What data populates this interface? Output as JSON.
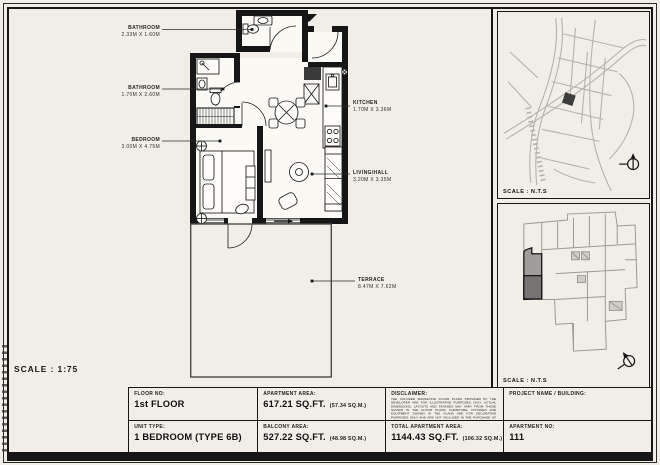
{
  "sheet": {
    "scale_label": "SCALE : 1:75",
    "bg_color": "#f0eee6",
    "line_color": "#161616",
    "accent_gray": "#767472"
  },
  "floor_plan": {
    "labels": [
      {
        "name": "BATHROOM",
        "dims": "2.33M X 1.60M"
      },
      {
        "name": "BATHROOM",
        "dims": "1.70M X 2.60M"
      },
      {
        "name": "BEDROOM",
        "dims": "3.00M X 4.75M"
      },
      {
        "name": "KITCHEN",
        "dims": "1.70M X 3.36M"
      },
      {
        "name": "LIVING/HALL",
        "dims": "3.20M X 3.35M"
      },
      {
        "name": "TERRACE",
        "dims": "8.47M X 7.62M"
      }
    ]
  },
  "location_map": {
    "scale_label": "SCALE : N.T.S"
  },
  "key_plan": {
    "scale_label": "SCALE : N.T.S"
  },
  "title_block": {
    "floor": {
      "label": "FLOOR NO:",
      "value": "1st FLOOR"
    },
    "unit_type": {
      "label": "UNIT TYPE:",
      "value": "1 BEDROOM (TYPE 6B)"
    },
    "apartment_area": {
      "label": "APARTMENT AREA:",
      "value": "617.21 SQ.FT.",
      "metric": "(57.34 SQ.M.)"
    },
    "balcony_area": {
      "label": "BALCONY AREA:",
      "value": "527.22 SQ.FT.",
      "metric": "(48.98 SQ.M.)"
    },
    "total_area": {
      "label": "TOTAL APARTMENT AREA:",
      "value": "1144.43 SQ.FT.",
      "metric": "(106.32 SQ.M.)"
    },
    "disclaimer": {
      "label": "DISCLAIMER:",
      "text": "THE COLORED MARKETING FLOOR PLANS PROVIDED BY THE DEVELOPER ARE FOR ILLUSTRATIVE PURPOSES ONLY. ACTUAL DIMENSIONS, LAYOUTS AND FINISHES MAY VARY FROM THOSE SHOWN IN THE FLOOR PLANS. FURNITURE, FIXTURES AND EQUIPMENT SHOWN IN THE PLANS ARE FOR DECORATIVE PURPOSES ONLY AND ARE NOT INCLUDED IN THE PURCHASE OF THE PROPERTY. THE DEVELOPER RESERVES THE RIGHT TO MAKE MODIFICATIONS, REVISIONS AND CHANGES TO THE FLOOR PLANS, SPECIFICATIONS AND MATERIALS WITHOUT PRIOR NOTICE."
    },
    "project": {
      "label": "PROJECT NAME / BUILDING:",
      "value": ""
    },
    "apartment_no": {
      "label": "APARTMENT NO:",
      "value": "111"
    }
  }
}
